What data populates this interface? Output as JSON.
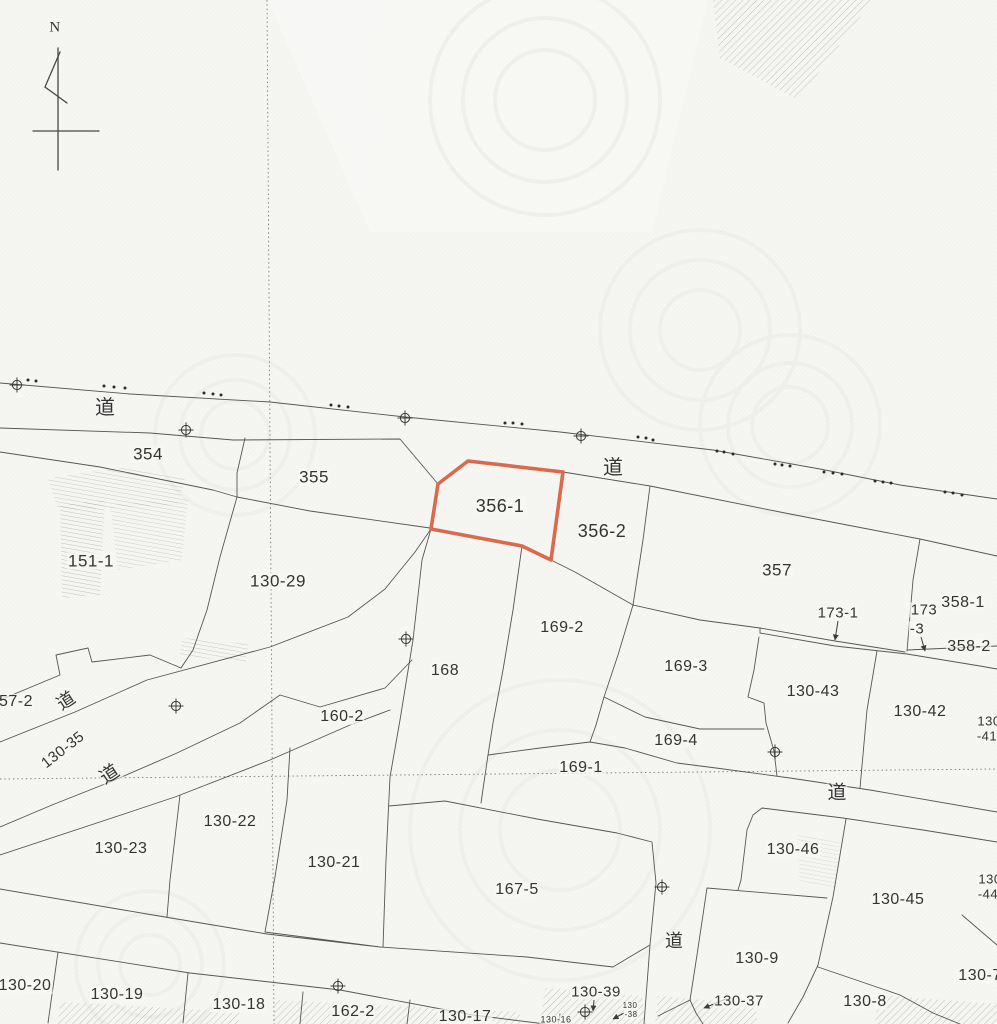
{
  "map": {
    "kind": "japanese-cadastral-map",
    "highlight": {
      "parcel": "356-1",
      "color": "#d96a4e"
    },
    "line_color": "#565656",
    "compass": {
      "label": "N",
      "x": 55,
      "y": 28
    },
    "parcel_labels": [
      {
        "id": "354",
        "text": "354",
        "x": 148,
        "y": 454,
        "fs": 17
      },
      {
        "id": "355",
        "text": "355",
        "x": 314,
        "y": 477,
        "fs": 17
      },
      {
        "id": "151-1",
        "text": "151-1",
        "x": 91,
        "y": 561,
        "fs": 17
      },
      {
        "id": "130-29",
        "text": "130-29",
        "x": 278,
        "y": 581,
        "fs": 17
      },
      {
        "id": "356-1",
        "text": "356-1",
        "x": 500,
        "y": 506,
        "fs": 18
      },
      {
        "id": "356-2",
        "text": "356-2",
        "x": 602,
        "y": 531,
        "fs": 18
      },
      {
        "id": "357",
        "text": "357",
        "x": 777,
        "y": 570,
        "fs": 17
      },
      {
        "id": "173-1",
        "text": "173-1",
        "x": 838,
        "y": 613,
        "fs": 15
      },
      {
        "id": "173-3-line1",
        "text": "173",
        "x": 924,
        "y": 610,
        "fs": 15
      },
      {
        "id": "173-3-line2",
        "text": "-3",
        "x": 917,
        "y": 629,
        "fs": 15
      },
      {
        "id": "358-1",
        "text": "358-1",
        "x": 963,
        "y": 603,
        "fs": 16
      },
      {
        "id": "358-2",
        "text": "358-2",
        "x": 969,
        "y": 647,
        "fs": 16
      },
      {
        "id": "169-2",
        "text": "169-2",
        "x": 562,
        "y": 628,
        "fs": 16
      },
      {
        "id": "169-3",
        "text": "169-3",
        "x": 686,
        "y": 667,
        "fs": 16
      },
      {
        "id": "168",
        "text": "168",
        "x": 445,
        "y": 671,
        "fs": 16
      },
      {
        "id": "130-43",
        "text": "130-43",
        "x": 813,
        "y": 692,
        "fs": 16
      },
      {
        "id": "130-42",
        "text": "130-42",
        "x": 920,
        "y": 712,
        "fs": 16
      },
      {
        "id": "130-41-line1",
        "text": "130",
        "x": 989,
        "y": 721,
        "fs": 13
      },
      {
        "id": "130-41-line2",
        "text": "-41",
        "x": 987,
        "y": 736,
        "fs": 13
      },
      {
        "id": "57-2",
        "text": "57-2",
        "x": 16,
        "y": 702,
        "fs": 16
      },
      {
        "id": "130-35",
        "text": "130-35",
        "x": 63,
        "y": 750,
        "fs": 15,
        "rot": -38
      },
      {
        "id": "160-2",
        "text": "160-2",
        "x": 342,
        "y": 717,
        "fs": 16
      },
      {
        "id": "169-4",
        "text": "169-4",
        "x": 676,
        "y": 741,
        "fs": 16
      },
      {
        "id": "169-1",
        "text": "169-1",
        "x": 581,
        "y": 768,
        "fs": 16
      },
      {
        "id": "130-22",
        "text": "130-22",
        "x": 230,
        "y": 822,
        "fs": 16
      },
      {
        "id": "130-23",
        "text": "130-23",
        "x": 121,
        "y": 849,
        "fs": 16
      },
      {
        "id": "130-21",
        "text": "130-21",
        "x": 334,
        "y": 863,
        "fs": 16
      },
      {
        "id": "167-5",
        "text": "167-5",
        "x": 517,
        "y": 890,
        "fs": 16
      },
      {
        "id": "130-46",
        "text": "130-46",
        "x": 793,
        "y": 850,
        "fs": 16
      },
      {
        "id": "130-45",
        "text": "130-45",
        "x": 898,
        "y": 900,
        "fs": 16
      },
      {
        "id": "130-44-line1",
        "text": "130",
        "x": 990,
        "y": 879,
        "fs": 13
      },
      {
        "id": "130-44-line2",
        "text": "-44",
        "x": 988,
        "y": 894,
        "fs": 13
      },
      {
        "id": "130-9",
        "text": "130-9",
        "x": 757,
        "y": 959,
        "fs": 16
      },
      {
        "id": "130-37",
        "text": "130-37",
        "x": 739,
        "y": 1001,
        "fs": 15
      },
      {
        "id": "130-8",
        "text": "130-8",
        "x": 865,
        "y": 1002,
        "fs": 16
      },
      {
        "id": "130-7",
        "text": "130-7",
        "x": 980,
        "y": 976,
        "fs": 16
      },
      {
        "id": "130-20",
        "text": "130-20",
        "x": 25,
        "y": 986,
        "fs": 16
      },
      {
        "id": "130-19",
        "text": "130-19",
        "x": 117,
        "y": 995,
        "fs": 16
      },
      {
        "id": "130-18",
        "text": "130-18",
        "x": 239,
        "y": 1005,
        "fs": 16
      },
      {
        "id": "162-2",
        "text": "162-2",
        "x": 353,
        "y": 1012,
        "fs": 16
      },
      {
        "id": "130-17",
        "text": "130-17",
        "x": 465,
        "y": 1017,
        "fs": 16
      },
      {
        "id": "130-39",
        "text": "130-39",
        "x": 596,
        "y": 992,
        "fs": 15
      },
      {
        "id": "130-16",
        "text": "130-16",
        "x": 556,
        "y": 1020,
        "fs": 9
      },
      {
        "id": "130-38-line1",
        "text": "130",
        "x": 630,
        "y": 1006,
        "fs": 8
      },
      {
        "id": "130-38-line2",
        "text": "-38",
        "x": 631,
        "y": 1015,
        "fs": 8
      }
    ],
    "road_labels": [
      {
        "id": "road-1",
        "text": "道",
        "x": 105,
        "y": 408,
        "fs": 20
      },
      {
        "id": "road-2",
        "text": "道",
        "x": 613,
        "y": 468,
        "fs": 20
      },
      {
        "id": "road-3",
        "text": "道",
        "x": 66,
        "y": 701,
        "fs": 18,
        "rot": -33
      },
      {
        "id": "road-4",
        "text": "道",
        "x": 110,
        "y": 775,
        "fs": 19,
        "rot": -33
      },
      {
        "id": "road-5",
        "text": "道",
        "x": 837,
        "y": 793,
        "fs": 19
      },
      {
        "id": "road-6",
        "text": "道",
        "x": 674,
        "y": 941,
        "fs": 18
      }
    ],
    "survey_markers": [
      [
        17,
        385
      ],
      [
        186,
        430
      ],
      [
        405,
        418
      ],
      [
        581,
        436
      ],
      [
        406,
        639
      ],
      [
        176,
        706
      ],
      [
        775,
        752
      ],
      [
        662,
        887
      ],
      [
        338,
        986
      ],
      [
        585,
        1012
      ]
    ],
    "boundary_dots": [
      [
        28,
        380
      ],
      [
        36,
        381
      ],
      [
        104,
        386
      ],
      [
        114,
        387
      ],
      [
        125,
        388
      ],
      [
        204,
        393
      ],
      [
        213,
        394
      ],
      [
        221,
        395
      ],
      [
        331,
        405
      ],
      [
        339,
        406
      ],
      [
        348,
        407
      ],
      [
        505,
        423
      ],
      [
        513,
        423
      ],
      [
        522,
        424
      ],
      [
        638,
        437
      ],
      [
        646,
        438
      ],
      [
        653,
        440
      ],
      [
        717,
        451
      ],
      [
        724,
        452
      ],
      [
        733,
        454
      ],
      [
        775,
        464
      ],
      [
        782,
        465
      ],
      [
        790,
        466
      ],
      [
        824,
        472
      ],
      [
        833,
        473
      ],
      [
        842,
        474
      ],
      [
        875,
        481
      ],
      [
        883,
        482
      ],
      [
        891,
        483
      ],
      [
        945,
        492
      ],
      [
        953,
        493
      ],
      [
        962,
        495
      ]
    ]
  }
}
